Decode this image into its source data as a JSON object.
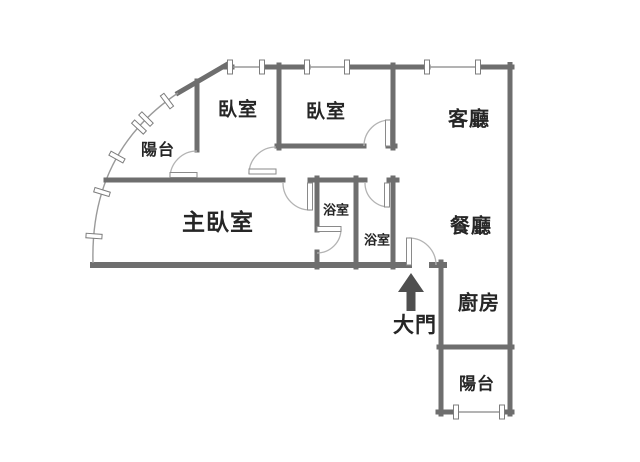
{
  "plan": {
    "type": "apartment-floor-plan",
    "rooms": {
      "bedroom1": {
        "label": "臥室"
      },
      "bedroom2": {
        "label": "臥室"
      },
      "living_room": {
        "label": "客廳"
      },
      "balcony_top": {
        "label": "陽台"
      },
      "master_bedroom": {
        "label": "主臥室"
      },
      "bathroom1": {
        "label": "浴室"
      },
      "bathroom2": {
        "label": "浴室"
      },
      "dining_room": {
        "label": "餐廳"
      },
      "kitchen": {
        "label": "廚房"
      },
      "balcony_bottom": {
        "label": "陽台"
      }
    },
    "entry": {
      "label": "大門",
      "arrow_icon": "arrow-up"
    },
    "colors": {
      "wall": "#6e6e6e",
      "window_line": "#9a9a9a",
      "door_arc": "#b3b3b3",
      "window_tick_border": "#7d7d7d",
      "arrow": "#4f4f4f",
      "text": "#262626",
      "background": "#ffffff"
    }
  }
}
